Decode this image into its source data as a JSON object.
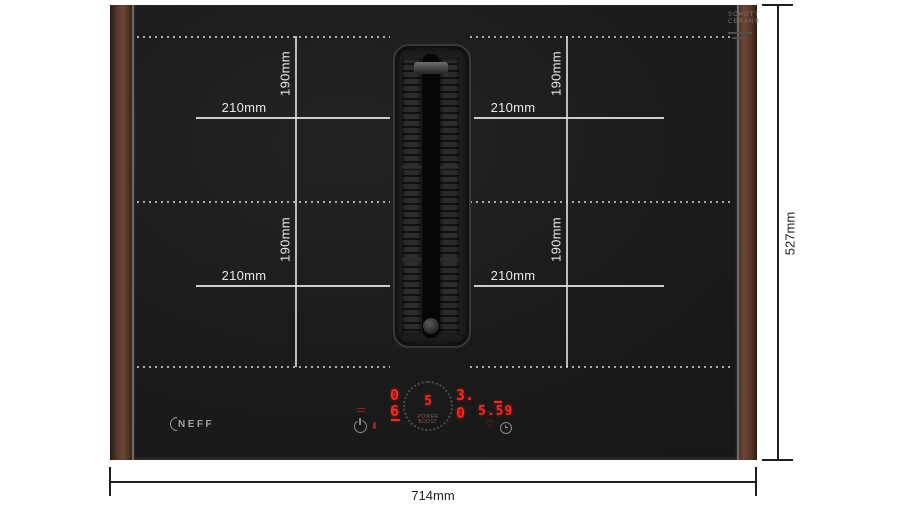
{
  "diagram": {
    "overall_width_label": "714mm",
    "overall_height_label": "527mm",
    "zone_width_label": "210mm",
    "zone_height_label": "190mm"
  },
  "hob": {
    "brand_logo": "NEFF",
    "glass_print_line1": "SCHOTT",
    "glass_print_line2": "CERAN®"
  },
  "control_panel": {
    "left_zone_top_level": "0",
    "left_zone_bottom_level": "6",
    "dial_level": "5",
    "dial_label_line1": "POWER",
    "dial_label_line2": "BOOST",
    "right_zone_top_level": "3.",
    "right_zone_bottom_level": "0",
    "timer_value": "5.59",
    "favorite_glyph": "♡"
  },
  "colors": {
    "digit_red": "#ff2318",
    "marking_white": "#e6e6e6",
    "wood_brown": "#5c3c30",
    "dimension_line": "#1f1f1f",
    "background": "#ffffff"
  }
}
